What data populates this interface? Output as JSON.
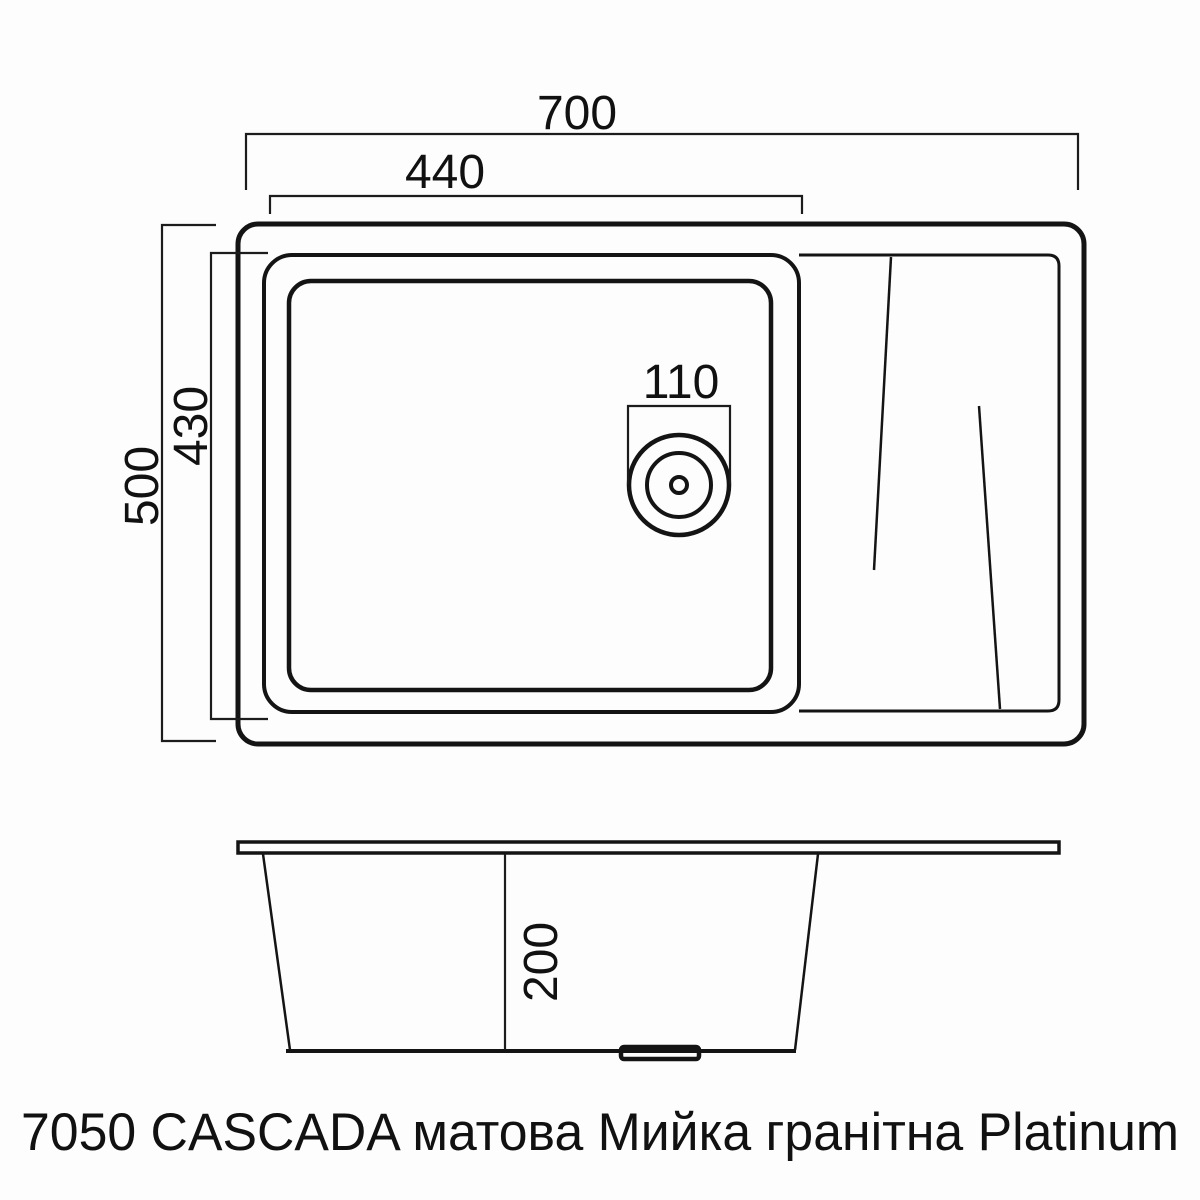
{
  "top_view": {
    "dim_overall_width": "700",
    "dim_bowl_width": "440",
    "dim_drain_hole": "110",
    "dim_overall_depth": "500",
    "dim_bowl_depth": "430"
  },
  "side_view": {
    "dim_bowl_height": "200"
  },
  "caption": {
    "text": "7050 CASCADA матова Мийка гранітна Platinum"
  },
  "colors": {
    "line": "#141414",
    "dimension_line": "#1c1c1c",
    "text": "#111111",
    "background": "#fdfdfd"
  }
}
